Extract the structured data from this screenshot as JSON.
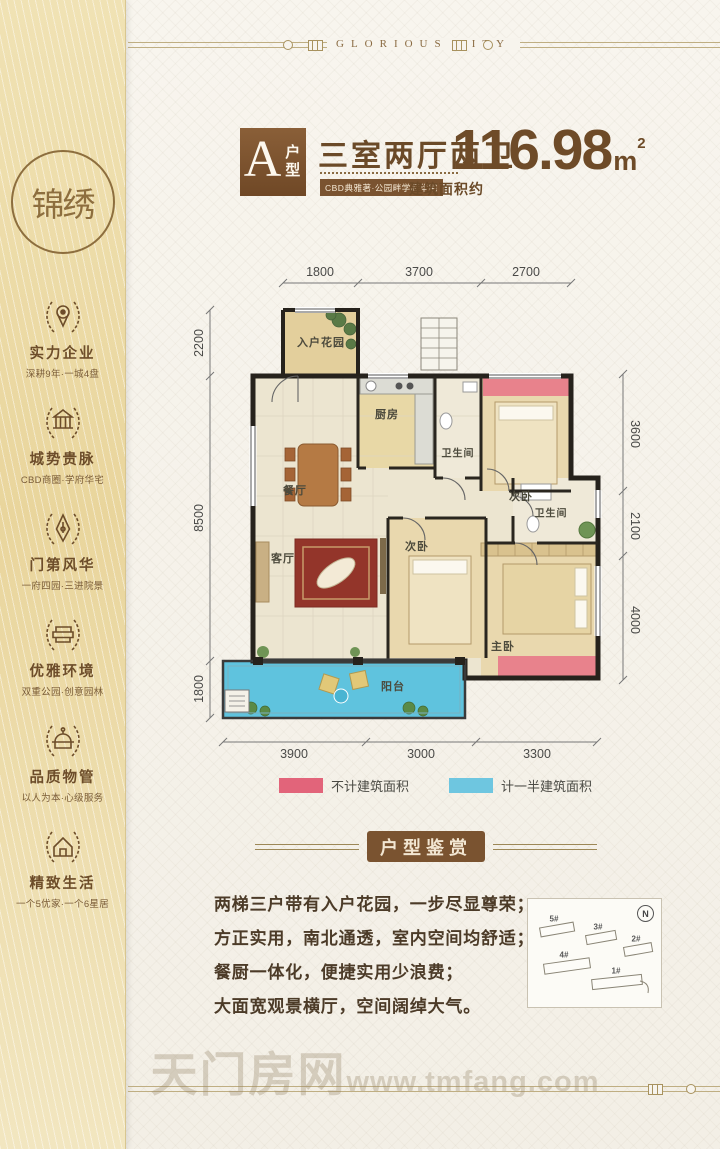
{
  "brand": {
    "name": "GLORIOUS CITY",
    "seal_text": "锦绣"
  },
  "sidebar": {
    "features": [
      {
        "icon": "laurel-location-pin-icon",
        "title": "实力企业",
        "subtitle": "深耕9年·一城4盘"
      },
      {
        "icon": "laurel-bank-icon",
        "title": "城势贵脉",
        "subtitle": "CBD商圈·学府华宅"
      },
      {
        "icon": "laurel-pen-nib-icon",
        "title": "门第风华",
        "subtitle": "一府四园·三进院景"
      },
      {
        "icon": "laurel-books-icon",
        "title": "优雅环境",
        "subtitle": "双重公园·创意园林"
      },
      {
        "icon": "laurel-dome-icon",
        "title": "品质物管",
        "subtitle": "以人为本·心级服务"
      },
      {
        "icon": "laurel-home-icon",
        "title": "精致生活",
        "subtitle": "一个5优家·一个6星居"
      }
    ]
  },
  "title": {
    "unit_letter": "A",
    "unit_suffix": "户型",
    "layout_name": "三室两厅两卫",
    "tagline": "CBD典雅著·公园畔学府华宅",
    "area_label": "建筑面积约",
    "area_value": "116.98",
    "area_unit": "m",
    "area_exp": "2"
  },
  "floorplan": {
    "rooms": {
      "entry_garden": "入户花园",
      "kitchen": "厨房",
      "bath_a": "卫生间",
      "bedroom_a": "次卧",
      "dining": "餐厅",
      "living": "客厅",
      "bedroom_b": "次卧",
      "bath_b": "卫生间",
      "master": "主卧",
      "balcony": "阳台"
    },
    "dims": {
      "top": [
        "1800",
        "3700",
        "2700"
      ],
      "left": [
        "2200",
        "8500",
        "1800"
      ],
      "right": [
        "3600",
        "2100",
        "4000"
      ],
      "bottom": [
        "3900",
        "3000",
        "3300"
      ]
    },
    "legend": [
      {
        "color": "#e2647a",
        "label": "不计建筑面积"
      },
      {
        "color": "#6ec6e0",
        "label": "计一半建筑面积"
      }
    ]
  },
  "section": {
    "title": "户型鉴赏"
  },
  "description": {
    "lines": [
      "两梯三户带有入户花园，一步尽显尊荣；",
      "方正实用，南北通透，室内空间均舒适；",
      "餐厨一体化，便捷实用少浪费；",
      "大面宽观景横厅，空间阔绰大气。"
    ]
  },
  "siteplan": {
    "north": "N",
    "buildings": [
      "5#",
      "3#",
      "2#",
      "4#",
      "1#"
    ]
  },
  "watermark": {
    "cn": "天门房网",
    "url": "www.tmfang.com"
  },
  "colors": {
    "accent_brown": "#7a5330",
    "sidebar_gold": "#eedfae",
    "legend_pink": "#e2647a",
    "legend_blue": "#6ec6e0",
    "plan_pink": "#e8828c",
    "plan_blue": "#5fc3de"
  }
}
